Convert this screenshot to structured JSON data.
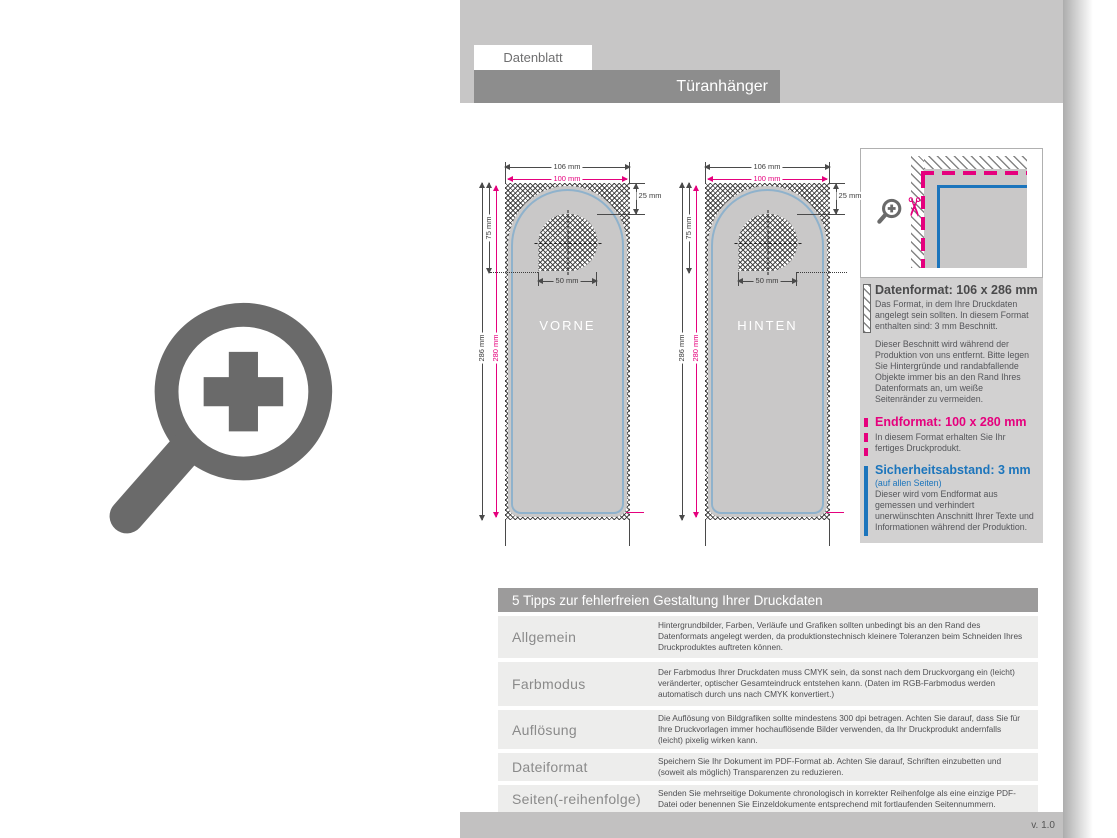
{
  "colors": {
    "magenta": "#e5007d",
    "blue": "#1c75bc",
    "safety_blue_light": "#8fb2cc",
    "title_bar_gray": "#8d8d8d",
    "top_band_gray": "#c7c6c6",
    "panel_gray": "#d2d1d1",
    "row_gray": "#ededec",
    "logo_gray": "#6a6a6a"
  },
  "icons": {
    "scissors": "✂"
  },
  "header": {
    "tab": "Datenblatt",
    "title": "Türanhänger"
  },
  "footer": {
    "version": "v. 1.0"
  },
  "diagram": {
    "front_label": "VORNE",
    "back_label": "HINTEN",
    "dims": {
      "outer_width": "106 mm",
      "inner_width": "100 mm",
      "outer_height": "286 mm",
      "inner_height": "280 mm",
      "hole_top_offset": "25 mm",
      "hole_bottom_offset": "75 mm",
      "hole_width": "50 mm"
    }
  },
  "info_panel": {
    "datenformat": {
      "title": "Datenformat: 106 x 286 mm",
      "paragraph1": "Das Format, in dem Ihre Druckdaten angelegt sein sollten. In diesem Format enthalten sind: 3 mm Beschnitt.",
      "paragraph2": "Dieser Beschnitt wird während der Produktion von uns entfernt. Bitte legen Sie Hintergründe und randabfallende Objekte immer bis an den Rand Ihres Datenformats an, um weiße Seitenränder zu vermeiden."
    },
    "endformat": {
      "title": "Endformat: 100 x 280 mm",
      "paragraph": "In diesem Format erhalten Sie Ihr fertiges Druckprodukt."
    },
    "sicherheitsabstand": {
      "title": "Sicherheitsabstand: 3 mm",
      "subtitle": "(auf allen Seiten)",
      "paragraph": "Dieser wird vom Endformat aus gemessen und verhindert unerwünschten Anschnitt Ihrer Texte und Informationen während der Produktion."
    }
  },
  "tips": {
    "title": "5 Tipps zur fehlerfreien Gestaltung Ihrer Druckdaten",
    "rows": [
      {
        "label": "Allgemein",
        "text": "Hintergrundbilder, Farben, Verläufe und Grafiken sollten unbedingt bis an den Rand des Datenformats angelegt werden, da produktionstechnisch kleinere Toleranzen beim Schneiden Ihres Druckproduktes auftreten können."
      },
      {
        "label": "Farbmodus",
        "text": "Der Farbmodus Ihrer Druckdaten muss CMYK sein, da sonst nach dem Druckvorgang ein (leicht) veränderter, optischer Gesamteindruck entstehen kann. (Daten im RGB-Farbmodus werden automatisch durch uns nach CMYK konvertiert.)"
      },
      {
        "label": "Auflösung",
        "text": "Die Auflösung von Bildgrafiken sollte mindestens 300 dpi betragen. Achten Sie darauf, dass Sie für Ihre Druckvorlagen immer hochauflösende Bilder verwenden, da Ihr Druckprodukt andernfalls (leicht) pixelig wirken kann."
      },
      {
        "label": "Dateiformat",
        "text": "Speichern Sie Ihr Dokument im PDF-Format ab. Achten Sie darauf, Schriften einzubetten und (soweit als möglich) Transparenzen zu reduzieren."
      },
      {
        "label": "Seiten(-reihenfolge)",
        "text": "Senden Sie mehrseitige Dokumente chronologisch in korrekter Reihenfolge als eine einzige PDF-Datei oder benennen Sie Einzeldokumente entsprechend mit fortlaufenden Seitennummern."
      }
    ]
  }
}
